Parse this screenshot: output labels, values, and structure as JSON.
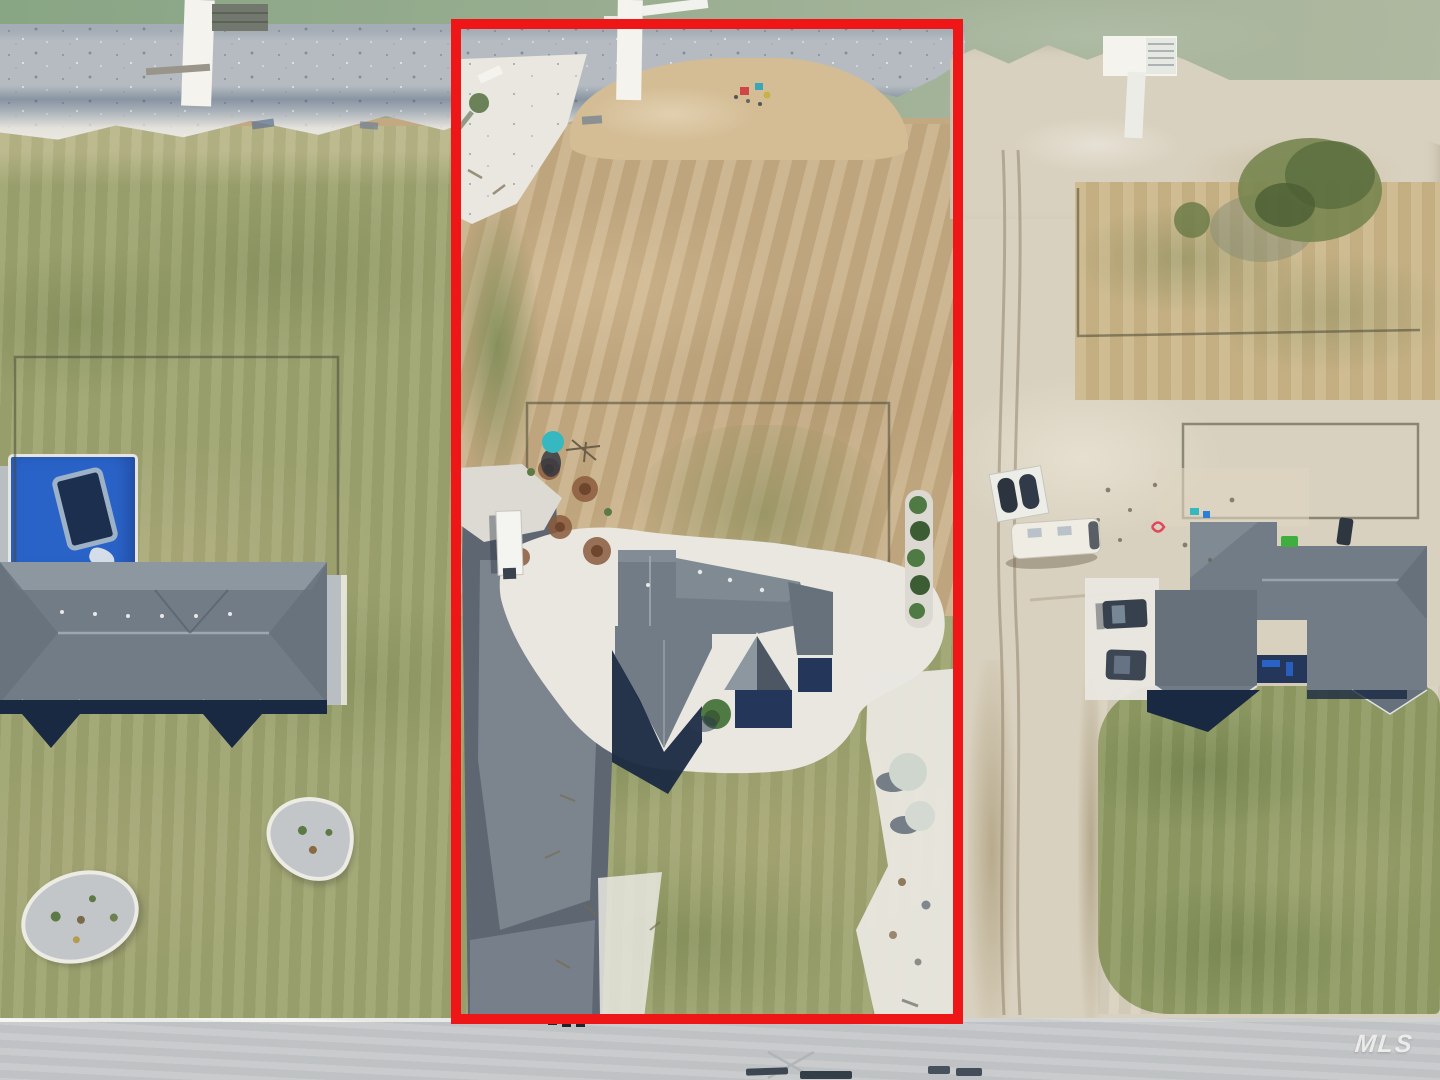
{
  "watermark": {
    "text": "MLS"
  },
  "annotation": {
    "boundary_color": "#ee1616",
    "boundary_shape": "rectangle"
  },
  "scene": {
    "type": "aerial-drone-photo",
    "features": [
      "lake-shoreline",
      "riprap-rocks",
      "three-docks",
      "highlighted-vacant-lot-with-house",
      "left-house-with-pool",
      "right-house-under-construction",
      "rv-trailer",
      "jetski-trailer",
      "dirt-road",
      "street"
    ]
  },
  "palette": {
    "water": "#9cb295",
    "sand": "#d9d1bf",
    "riprap": "#b5bbc0",
    "grass": "#9da36f",
    "grass2": "#8e9a63",
    "dirt": "#c3a981",
    "dirt_light": "#d4bd95",
    "gravel": "#c3c6c9",
    "concrete": "#e9e7e0",
    "pad": "#b9bec3",
    "asphalt": "#5d6671",
    "asphalt_light": "#8b929c",
    "roof": "#727c87",
    "roof_light": "#8d97a0",
    "roof_mid": "#67717c",
    "roof_dark": "#4c5763",
    "shadow_navy": "#1a2942",
    "navy": "#24365a",
    "pool": "#2a63c8",
    "pool_dark": "#1c2f4f",
    "teal": "#35b8c0",
    "rust": "#8a5a3c",
    "tree": "#4f7a44",
    "tree_dark": "#3c5c34",
    "road": "#c6c8ca",
    "boundary": "#ee1616",
    "white": "#f4f3ee",
    "fence": "#4b4837"
  }
}
